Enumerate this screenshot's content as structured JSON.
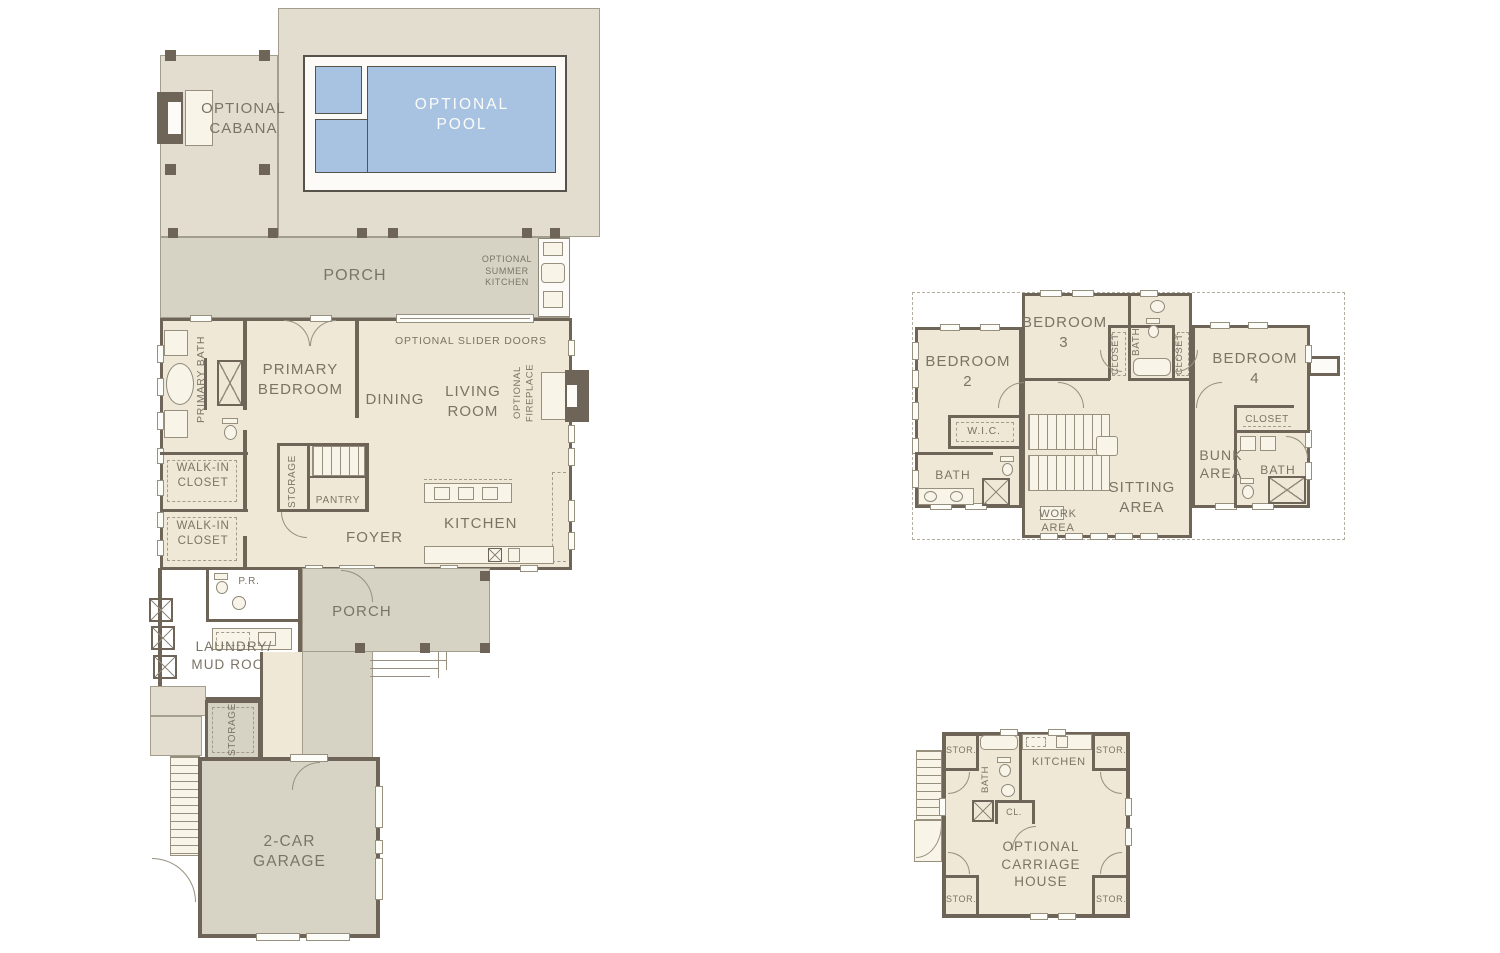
{
  "colors": {
    "interior_cream": "#EFE8D6",
    "deck_beige": "#E2DDCF",
    "porch_gray": "#D6D3C5",
    "garage_gray": "#D7D4C6",
    "pool_blue": "#A8C3E1",
    "wall_dark": "#6E6457",
    "label_text": "#7A7466"
  },
  "first_floor": {
    "labels": {
      "cabana": "OPTIONAL CABANA",
      "pool": "OPTIONAL POOL",
      "porch_upper": "PORCH",
      "summer_kitchen": "OPTIONAL SUMMER KITCHEN",
      "slider_doors": "OPTIONAL SLIDER DOORS",
      "primary_bath": "PRIMARY BATH",
      "primary_bedroom": "PRIMARY BEDROOM",
      "dining": "DINING",
      "living_room": "LIVING ROOM",
      "fireplace": "OPTIONAL FIREPLACE",
      "walk_in_closet_1": "WALK-IN CLOSET",
      "walk_in_closet_2": "WALK-IN CLOSET",
      "storage_upper": "STORAGE",
      "pantry": "PANTRY",
      "foyer": "FOYER",
      "kitchen": "KITCHEN",
      "powder_room": "P.R.",
      "laundry": "LAUNDRY/ MUD ROOM",
      "porch_lower": "PORCH",
      "storage_lower": "STORAGE",
      "garage": "2-CAR GARAGE"
    }
  },
  "second_floor": {
    "labels": {
      "bedroom_2": "BEDROOM 2",
      "bedroom_3": "BEDROOM 3",
      "closet_a": "CLOSET",
      "bath_a": "BATH",
      "closet_b": "CLOSET",
      "bedroom_4": "BEDROOM 4",
      "wic": "W.I.C.",
      "bath_b": "BATH",
      "work_area": "WORK AREA",
      "sitting_area": "SITTING AREA",
      "bunk_area": "BUNK AREA",
      "closet_c": "CLOSET",
      "bath_c": "BATH"
    }
  },
  "carriage_house": {
    "labels": {
      "stor_tl": "STOR.",
      "stor_tr": "STOR.",
      "stor_bl": "STOR.",
      "stor_br": "STOR.",
      "kitchen": "KITCHEN",
      "bath": "BATH",
      "closet": "CL.",
      "name": "OPTIONAL CARRIAGE HOUSE"
    }
  }
}
